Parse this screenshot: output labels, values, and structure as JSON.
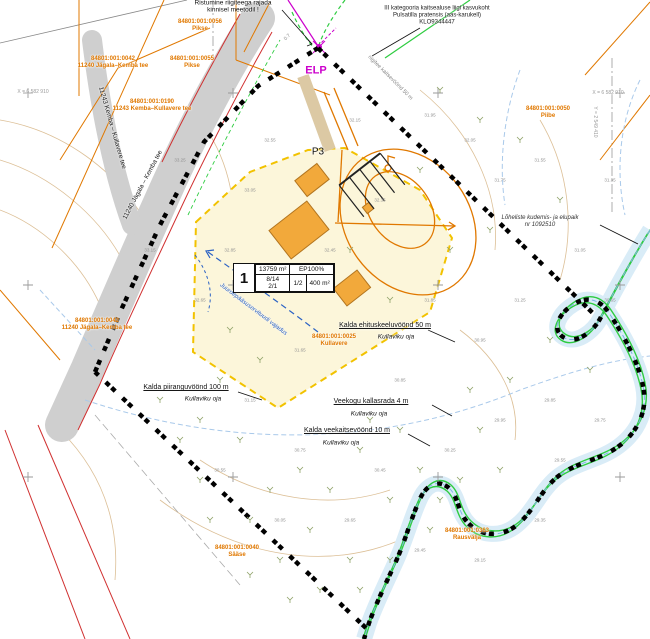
{
  "map": {
    "colors": {
      "cadastral_orange": "#e07800",
      "boundary_black": "#000000",
      "water_blue": "#7fb2e5",
      "nature_green": "#2ecc40",
      "magenta": "#cc00cc",
      "road_gray": "#cfcfcf",
      "building_orange": "#f2a93b",
      "parcel_fill": "#fcf6da",
      "parcel_border": "#f2c200",
      "protection_red": "#d03030",
      "contour_tan": "#dcbf96"
    },
    "parcel_table": {
      "nr": "1",
      "area": "13759 m²",
      "ep": "EP100%",
      "c1a": "8/14",
      "c1b": "2/1",
      "c2": "1/2",
      "c3": "400 m²"
    },
    "labels": [
      {
        "n": "note-crossing",
        "t": "Ristumine riigiteega rajada\nkinnisel meetodil !",
        "x": 233,
        "y": 7,
        "c": "#111111",
        "s": 6.5
      },
      {
        "n": "cad-pikse-1",
        "t": "84801:001:0056\nPikse",
        "x": 200,
        "y": 26,
        "c": "#e07800",
        "s": 6,
        "b": 1
      },
      {
        "n": "cad-pikse-2",
        "t": "84801:001:0055\nPikse",
        "x": 192,
        "y": 63,
        "c": "#e07800",
        "s": 6,
        "b": 1
      },
      {
        "n": "cad-road-nw",
        "t": "84801:001:0042\n11240 Jägala–Kemba tee",
        "x": 113,
        "y": 63,
        "c": "#e07800",
        "s": 6,
        "b": 1
      },
      {
        "n": "cad-road-branch",
        "t": "84801:001:0190\n11243 Kemba–Kullavere tee",
        "x": 152,
        "y": 106,
        "c": "#e07800",
        "s": 6,
        "b": 1
      },
      {
        "n": "note-species",
        "t": "III kategooria kaitsealuse liigi kasvukoht\nPulsatilla pratensis (aas-karukell)\nKLO9344447",
        "x": 437,
        "y": 16,
        "c": "#222222",
        "s": 6
      },
      {
        "n": "label-elp",
        "t": "ELP",
        "x": 316,
        "y": 71,
        "c": "#cc00cc",
        "s": 11,
        "b": 1
      },
      {
        "n": "label-p3",
        "t": "P3",
        "x": 318,
        "y": 152,
        "c": "#111111",
        "s": 10
      },
      {
        "n": "zone-ehituskeeluvoond",
        "t": "Kalda ehituskeeluvöönd 50 m",
        "x": 385,
        "y": 326,
        "c": "#111111",
        "s": 7,
        "u": 1
      },
      {
        "n": "zone-ehituskeeluvoond-oja",
        "t": "Kullaviku oja",
        "x": 396,
        "y": 337,
        "c": "#111111",
        "s": 6.5,
        "i": 1
      },
      {
        "n": "zone-kallasrada",
        "t": "Veekogu kallasrada 4 m",
        "x": 371,
        "y": 402,
        "c": "#111111",
        "s": 7,
        "u": 1
      },
      {
        "n": "zone-kallasrada-oja",
        "t": "Kullaviku oja",
        "x": 369,
        "y": 414,
        "c": "#111111",
        "s": 6.5,
        "i": 1
      },
      {
        "n": "zone-veekaitse",
        "t": "Kalda veekaitsevöönd 10 m",
        "x": 347,
        "y": 431,
        "c": "#111111",
        "s": 7,
        "u": 1
      },
      {
        "n": "zone-veekaitse-oja",
        "t": "Kullaviku oja",
        "x": 341,
        "y": 443,
        "c": "#111111",
        "s": 6.5,
        "i": 1
      },
      {
        "n": "zone-piirang",
        "t": "Kalda piiranguvöönd 100 m",
        "x": 186,
        "y": 388,
        "c": "#111111",
        "s": 7,
        "u": 1
      },
      {
        "n": "zone-piirang-oja",
        "t": "Kullaviku oja",
        "x": 203,
        "y": 399,
        "c": "#111111",
        "s": 6.5,
        "i": 1
      },
      {
        "n": "note-loheliste",
        "t": "Lõheliste kudemis- ja elupaik\nnr 1092510",
        "x": 540,
        "y": 222,
        "c": "#333333",
        "s": 6,
        "i": 1
      },
      {
        "n": "cad-piibe",
        "t": "84801:001:0050\nPiibe",
        "x": 548,
        "y": 113,
        "c": "#e07800",
        "s": 6,
        "b": 1
      },
      {
        "n": "cad-rausvalja",
        "t": "84801:001:0363\nRausvälja",
        "x": 467,
        "y": 535,
        "c": "#e07800",
        "s": 6,
        "b": 1
      },
      {
        "n": "cad-saase",
        "t": "84801:001:0040\nSääse",
        "x": 237,
        "y": 552,
        "c": "#e07800",
        "s": 6,
        "b": 1
      },
      {
        "n": "cad-road-w",
        "t": "84801:001:0042\n11240 Jägala–Kemba tee",
        "x": 97,
        "y": 325,
        "c": "#e07800",
        "s": 6,
        "b": 1
      },
      {
        "n": "cad-kullavere",
        "t": "84801:001:0025\nKullavere",
        "x": 334,
        "y": 341,
        "c": "#e07800",
        "s": 6,
        "b": 1
      },
      {
        "n": "note-servituut",
        "t": "Juurdepääsuservituudi vajadus",
        "x": 253,
        "y": 310,
        "c": "#2b62c4",
        "s": 6,
        "i": 1,
        "r": 37
      },
      {
        "n": "road-name-branch",
        "t": "11243 Kemba – Kullavere tee",
        "x": 112,
        "y": 128,
        "c": "#222222",
        "s": 6.5,
        "r": 74
      },
      {
        "n": "road-name-main",
        "t": "11240 Jägala – Kemba tee",
        "x": 143,
        "y": 185,
        "c": "#222222",
        "s": 6.5,
        "r": -62
      },
      {
        "n": "grid-x-left",
        "t": "X = 6 582 910",
        "x": 33,
        "y": 93,
        "c": "#9a9a9a",
        "s": 5
      },
      {
        "n": "grid-x-right",
        "t": "X = 6 582 910",
        "x": 608,
        "y": 94,
        "c": "#9a9a9a",
        "s": 5
      },
      {
        "n": "grid-y-right",
        "t": "Y = 2 549 410",
        "x": 594,
        "y": 122,
        "c": "#9a9a9a",
        "s": 5,
        "r": 90
      },
      {
        "n": "zone-riigitee",
        "t": "riigitee kaitsevöönd 50 m",
        "x": 390,
        "y": 78,
        "c": "#888888",
        "s": 5.5,
        "r": 45
      },
      {
        "n": "dim-07",
        "t": "0.7",
        "x": 288,
        "y": 38,
        "c": "#888888",
        "s": 5,
        "r": -45
      }
    ],
    "elevations": [
      {
        "t": "32.15",
        "x": 355,
        "y": 120
      },
      {
        "t": "31.95",
        "x": 430,
        "y": 115
      },
      {
        "t": "32.05",
        "x": 470,
        "y": 140
      },
      {
        "t": "31.75",
        "x": 500,
        "y": 180
      },
      {
        "t": "32.35",
        "x": 380,
        "y": 200
      },
      {
        "t": "33.05",
        "x": 250,
        "y": 190
      },
      {
        "t": "32.85",
        "x": 230,
        "y": 250
      },
      {
        "t": "32.45",
        "x": 330,
        "y": 250
      },
      {
        "t": "31.85",
        "x": 430,
        "y": 300
      },
      {
        "t": "30.95",
        "x": 480,
        "y": 340
      },
      {
        "t": "31.25",
        "x": 520,
        "y": 300
      },
      {
        "t": "31.65",
        "x": 300,
        "y": 350
      },
      {
        "t": "31.15",
        "x": 250,
        "y": 400
      },
      {
        "t": "30.75",
        "x": 300,
        "y": 450
      },
      {
        "t": "30.45",
        "x": 380,
        "y": 470
      },
      {
        "t": "30.25",
        "x": 450,
        "y": 450
      },
      {
        "t": "29.95",
        "x": 500,
        "y": 420
      },
      {
        "t": "29.85",
        "x": 550,
        "y": 400
      },
      {
        "t": "32.65",
        "x": 200,
        "y": 300
      },
      {
        "t": "33.15",
        "x": 150,
        "y": 250
      },
      {
        "t": "30.85",
        "x": 400,
        "y": 380
      },
      {
        "t": "29.65",
        "x": 350,
        "y": 520
      },
      {
        "t": "29.45",
        "x": 420,
        "y": 550
      },
      {
        "t": "30.05",
        "x": 280,
        "y": 520
      },
      {
        "t": "30.55",
        "x": 220,
        "y": 470
      },
      {
        "t": "29.15",
        "x": 480,
        "y": 560
      },
      {
        "t": "29.35",
        "x": 540,
        "y": 520
      },
      {
        "t": "29.55",
        "x": 560,
        "y": 460
      },
      {
        "t": "29.75",
        "x": 600,
        "y": 420
      },
      {
        "t": "30.65",
        "x": 610,
        "y": 300
      },
      {
        "t": "31.05",
        "x": 580,
        "y": 250
      },
      {
        "t": "31.55",
        "x": 540,
        "y": 160
      },
      {
        "t": "31.35",
        "x": 610,
        "y": 180
      },
      {
        "t": "32.55",
        "x": 270,
        "y": 140
      },
      {
        "t": "33.25",
        "x": 180,
        "y": 160
      }
    ],
    "trees": [
      [
        300,
        470
      ],
      [
        330,
        490
      ],
      [
        360,
        450
      ],
      [
        390,
        500
      ],
      [
        270,
        490
      ],
      [
        240,
        440
      ],
      [
        310,
        530
      ],
      [
        350,
        560
      ],
      [
        280,
        560
      ],
      [
        250,
        520
      ],
      [
        420,
        470
      ],
      [
        400,
        430
      ],
      [
        370,
        420
      ],
      [
        440,
        500
      ],
      [
        200,
        420
      ],
      [
        220,
        380
      ],
      [
        180,
        440
      ],
      [
        460,
        480
      ],
      [
        430,
        530
      ],
      [
        390,
        560
      ],
      [
        360,
        590
      ],
      [
        320,
        590
      ],
      [
        480,
        430
      ],
      [
        500,
        470
      ],
      [
        260,
        360
      ],
      [
        230,
        330
      ],
      [
        510,
        380
      ],
      [
        470,
        390
      ],
      [
        200,
        480
      ],
      [
        160,
        400
      ],
      [
        440,
        90
      ],
      [
        480,
        120
      ],
      [
        520,
        140
      ],
      [
        560,
        200
      ],
      [
        420,
        170
      ],
      [
        350,
        250
      ],
      [
        390,
        300
      ],
      [
        450,
        250
      ],
      [
        490,
        230
      ],
      [
        550,
        340
      ],
      [
        590,
        370
      ],
      [
        290,
        600
      ],
      [
        250,
        575
      ],
      [
        210,
        520
      ]
    ],
    "crosses": [
      [
        28,
        93
      ],
      [
        233,
        93
      ],
      [
        438,
        93
      ],
      [
        620,
        93
      ],
      [
        28,
        285
      ],
      [
        233,
        285
      ],
      [
        438,
        285
      ],
      [
        620,
        285
      ],
      [
        28,
        477
      ],
      [
        233,
        477
      ],
      [
        438,
        477
      ],
      [
        620,
        477
      ]
    ]
  }
}
